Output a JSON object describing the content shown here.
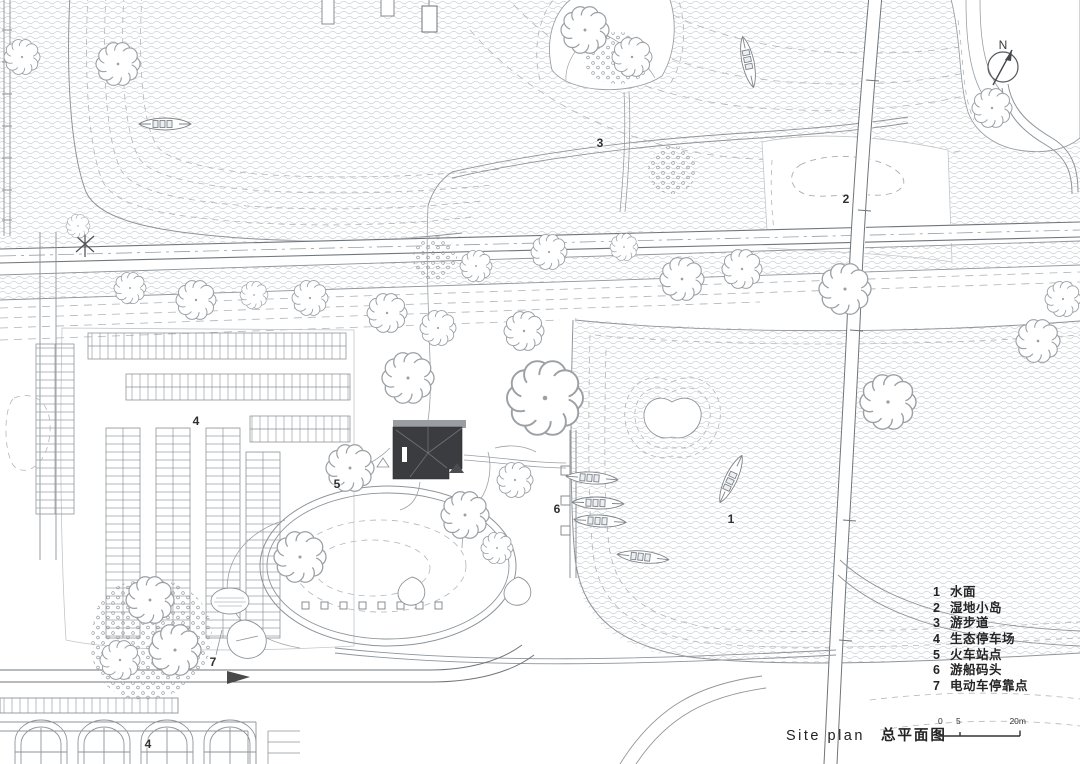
{
  "title": {
    "en": "Site plan",
    "zh": "总平面图"
  },
  "scale": {
    "labels": [
      "0",
      "5",
      "20m"
    ]
  },
  "north": {
    "label": "N"
  },
  "legend": {
    "items": [
      {
        "num": "1",
        "label": "水面"
      },
      {
        "num": "2",
        "label": "湿地小岛"
      },
      {
        "num": "3",
        "label": "游步道"
      },
      {
        "num": "4",
        "label": "生态停车场"
      },
      {
        "num": "5",
        "label": "火车站点"
      },
      {
        "num": "6",
        "label": "游船码头"
      },
      {
        "num": "7",
        "label": "电动车停靠点"
      }
    ]
  },
  "markers": [
    {
      "n": "3"
    },
    {
      "n": "2"
    },
    {
      "n": "1"
    },
    {
      "n": "4"
    },
    {
      "n": "5"
    },
    {
      "n": "6"
    },
    {
      "n": "7"
    },
    {
      "n": "4"
    }
  ],
  "colors": {
    "line": "#8f959a",
    "water_wave": "#c9cdd1",
    "dashed_contour": "#b2b7bc",
    "dark_building": "#3a3c40",
    "text": "#2b2b2b"
  }
}
